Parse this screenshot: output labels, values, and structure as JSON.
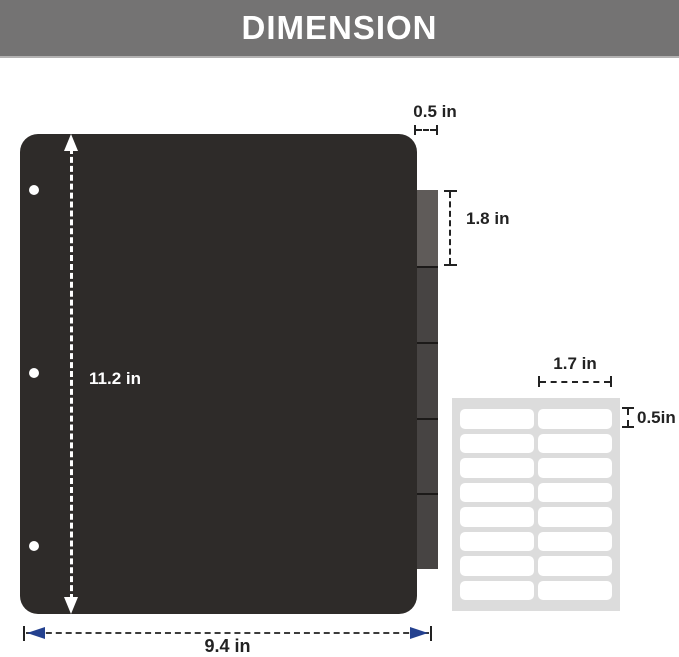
{
  "header": {
    "title": "DIMENSION"
  },
  "diagram": {
    "divider": {
      "height_label": "11.2 in",
      "width_label": "9.4 in",
      "hole_count": 3,
      "tab_count": 5
    },
    "tab": {
      "width_label": "0.5 in",
      "height_label": "1.8 in"
    },
    "label_sheet": {
      "columns": 2,
      "rows": 8,
      "width_label": "1.7 in",
      "height_label": "0.5in"
    }
  },
  "colors": {
    "banner": "#747373",
    "banner_text": "#ffffff",
    "divider": "#2e2b29",
    "tab_first": "#5f5b59",
    "tab_rest": "#474443",
    "hole": "#ffffff",
    "sheet": "#dcdcdc",
    "label": "#ffffff",
    "dim_dark": "#222222",
    "dim_light": "#ffffff",
    "arrow_blue": "#24418f"
  }
}
